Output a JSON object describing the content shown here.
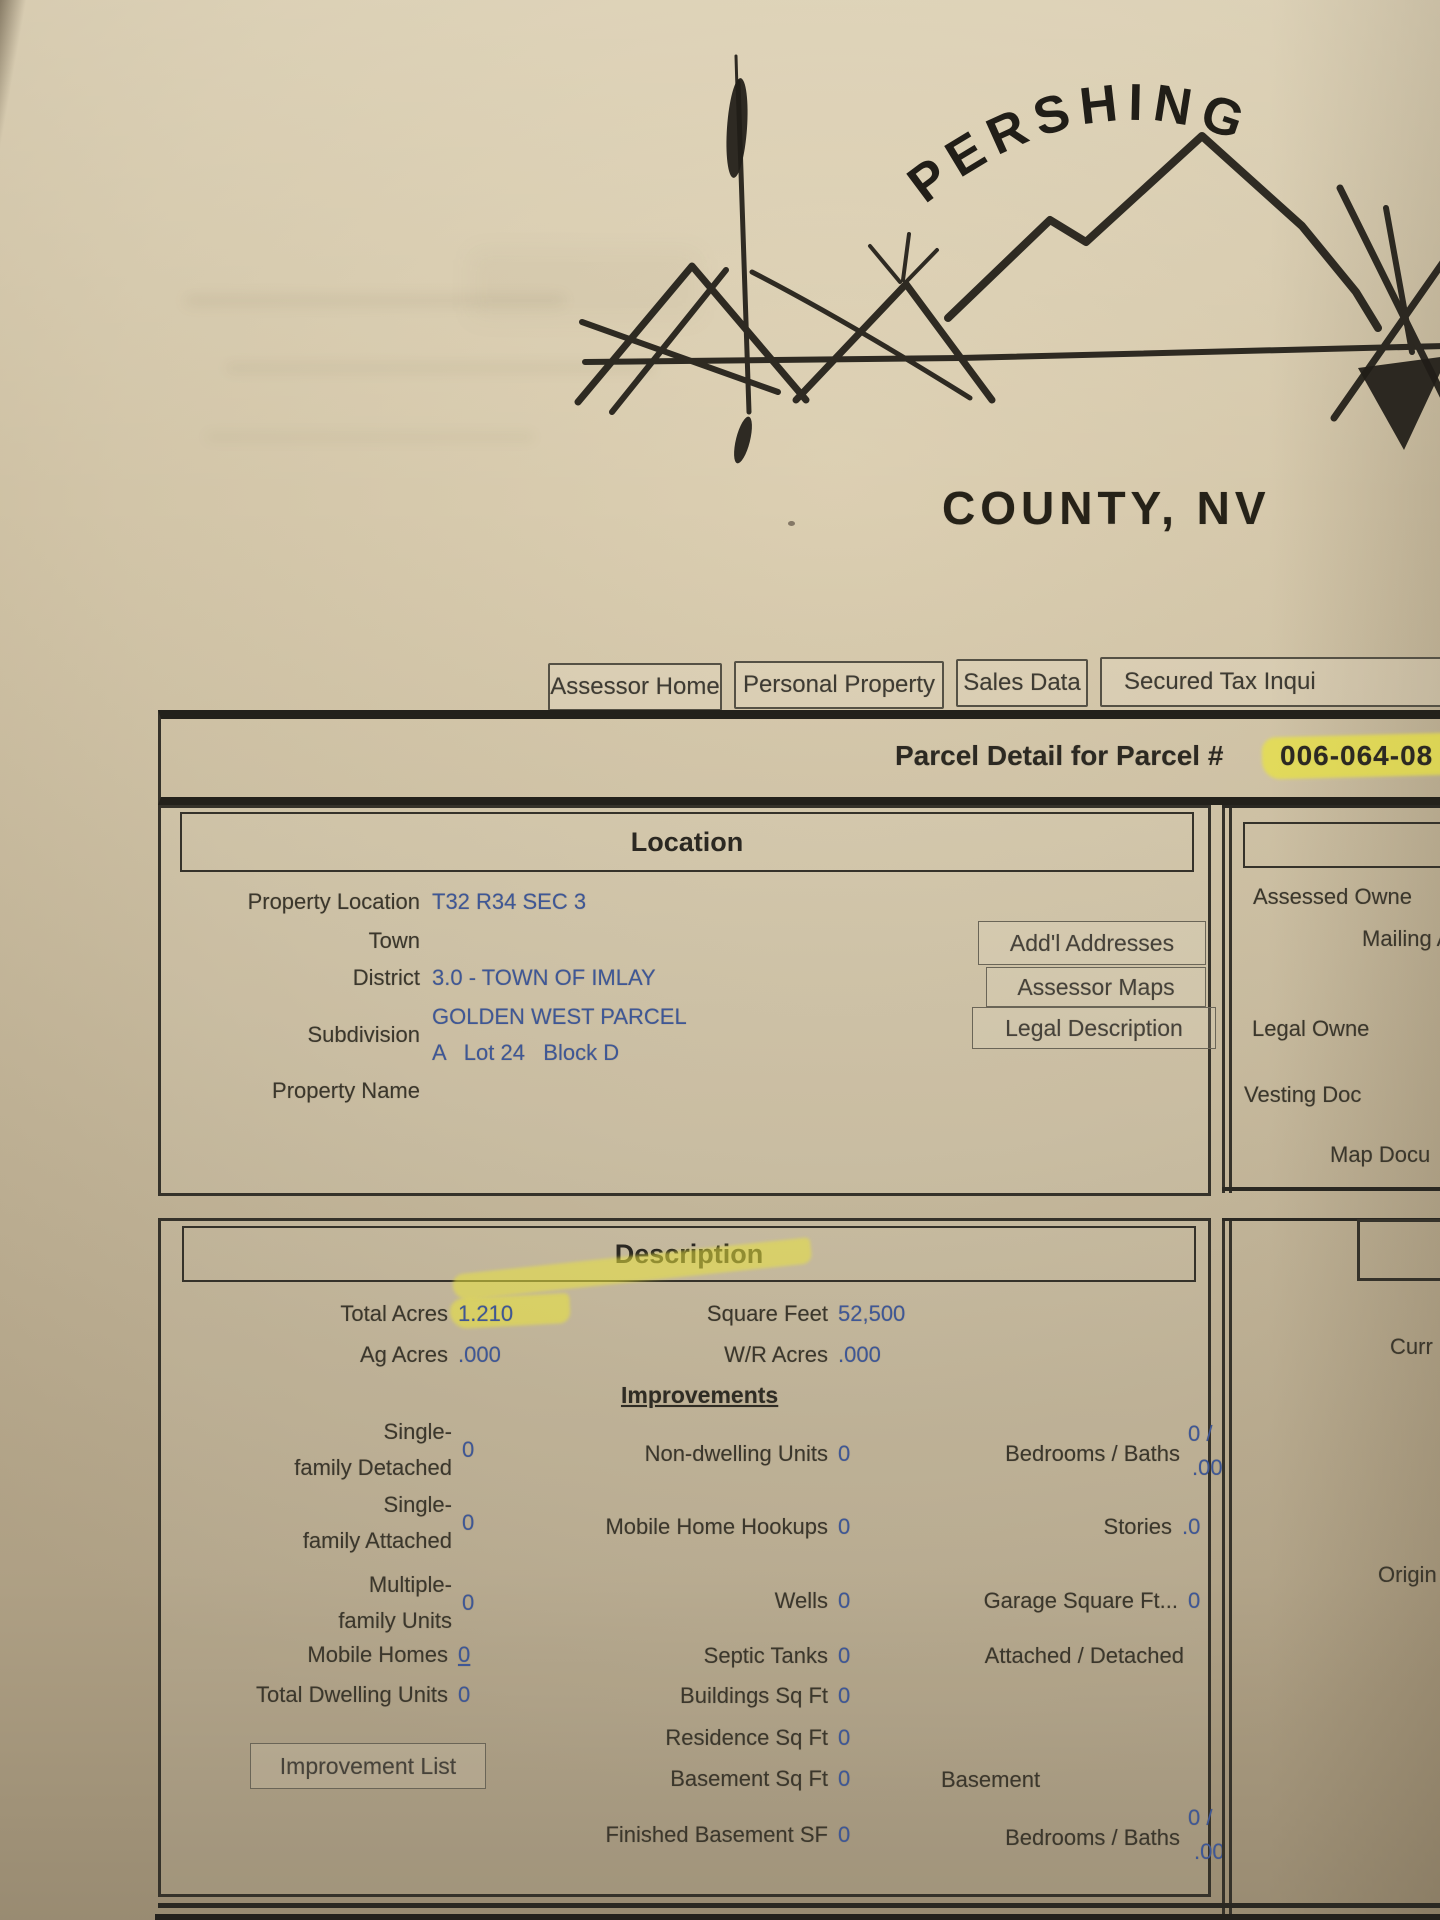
{
  "colors": {
    "paper": "#d2c5a8",
    "ink": "#3b372c",
    "value_blue": "#3e5796",
    "highlight_yellow": "#e9e33e",
    "box_border": "#35322a"
  },
  "logo": {
    "arc_text": "PERSHING",
    "county_text": "COUNTY, NV"
  },
  "nav": {
    "items": [
      "Assessor Home",
      "Personal Property",
      "Sales Data",
      "Secured Tax Inqui"
    ]
  },
  "banner": {
    "title": "Parcel Detail for Parcel #",
    "parcel_number": "006-064-08"
  },
  "location": {
    "header": "Location",
    "property_location_label": "Property Location",
    "property_location": "T32 R34 SEC 3",
    "town_label": "Town",
    "district_label": "District",
    "district": "3.0 - TOWN OF IMLAY",
    "subdivision_label": "Subdivision",
    "subdivision_line1": "GOLDEN WEST PARCEL",
    "subdivision_line2": "A   Lot 24   Block D",
    "property_name_label": "Property Name",
    "buttons": [
      "Add'l Addresses",
      "Assessor Maps",
      "Legal Description"
    ]
  },
  "owner_panel": {
    "assessed_owner": "Assessed Owne",
    "mailing_address": "Mailing A",
    "legal_owner": "Legal Owne",
    "vesting_doc": "Vesting Doc",
    "map_doc": "Map Docu"
  },
  "description": {
    "header": "Description",
    "total_acres_label": "Total Acres",
    "total_acres": "1.210",
    "square_feet_label": "Square Feet",
    "square_feet": "52,500",
    "ag_acres_label": "Ag Acres",
    "ag_acres": ".000",
    "wr_acres_label": "W/R Acres",
    "wr_acres": ".000",
    "improvements_header": "Improvements",
    "single_detached_l1": "Single-",
    "single_detached_l2": "family Detached",
    "single_detached": "0",
    "non_dwelling_label": "Non-dwelling Units",
    "non_dwelling": "0",
    "bedrooms_baths_label": "Bedrooms / Baths",
    "bedrooms_baths_top": "0 /",
    "bedrooms_baths_bottom": ".00",
    "single_attached_l1": "Single-",
    "single_attached_l2": "family Attached",
    "single_attached": "0",
    "mobile_hookups_label": "Mobile Home Hookups",
    "mobile_hookups": "0",
    "stories_label": "Stories",
    "stories": ".0",
    "multi_family_l1": "Multiple-",
    "multi_family_l2": "family Units",
    "multi_family": "0",
    "wells_label": "Wells",
    "wells": "0",
    "garage_label": "Garage Square Ft...",
    "garage": "0",
    "mobile_homes_label": "Mobile Homes",
    "mobile_homes": "0",
    "septic_label": "Septic Tanks",
    "septic": "0",
    "attached_detached_label": "Attached / Detached",
    "total_dwelling_label": "Total Dwelling Units",
    "total_dwelling": "0",
    "buildings_label": "Buildings Sq Ft",
    "buildings": "0",
    "residence_label": "Residence Sq Ft",
    "residence": "0",
    "basement_sqft_label": "Basement Sq Ft",
    "basement_sqft": "0",
    "basement_label": "Basement",
    "improvement_list_button": "Improvement List",
    "finished_basement_label": "Finished Basement SF",
    "finished_basement": "0",
    "bedrooms_baths2_label": "Bedrooms / Baths",
    "bedrooms_baths2_top": "0 /",
    "bedrooms_baths2_bottom": ".00"
  },
  "value_panel": {
    "current_label": "Curr",
    "original_label": "Origin"
  }
}
